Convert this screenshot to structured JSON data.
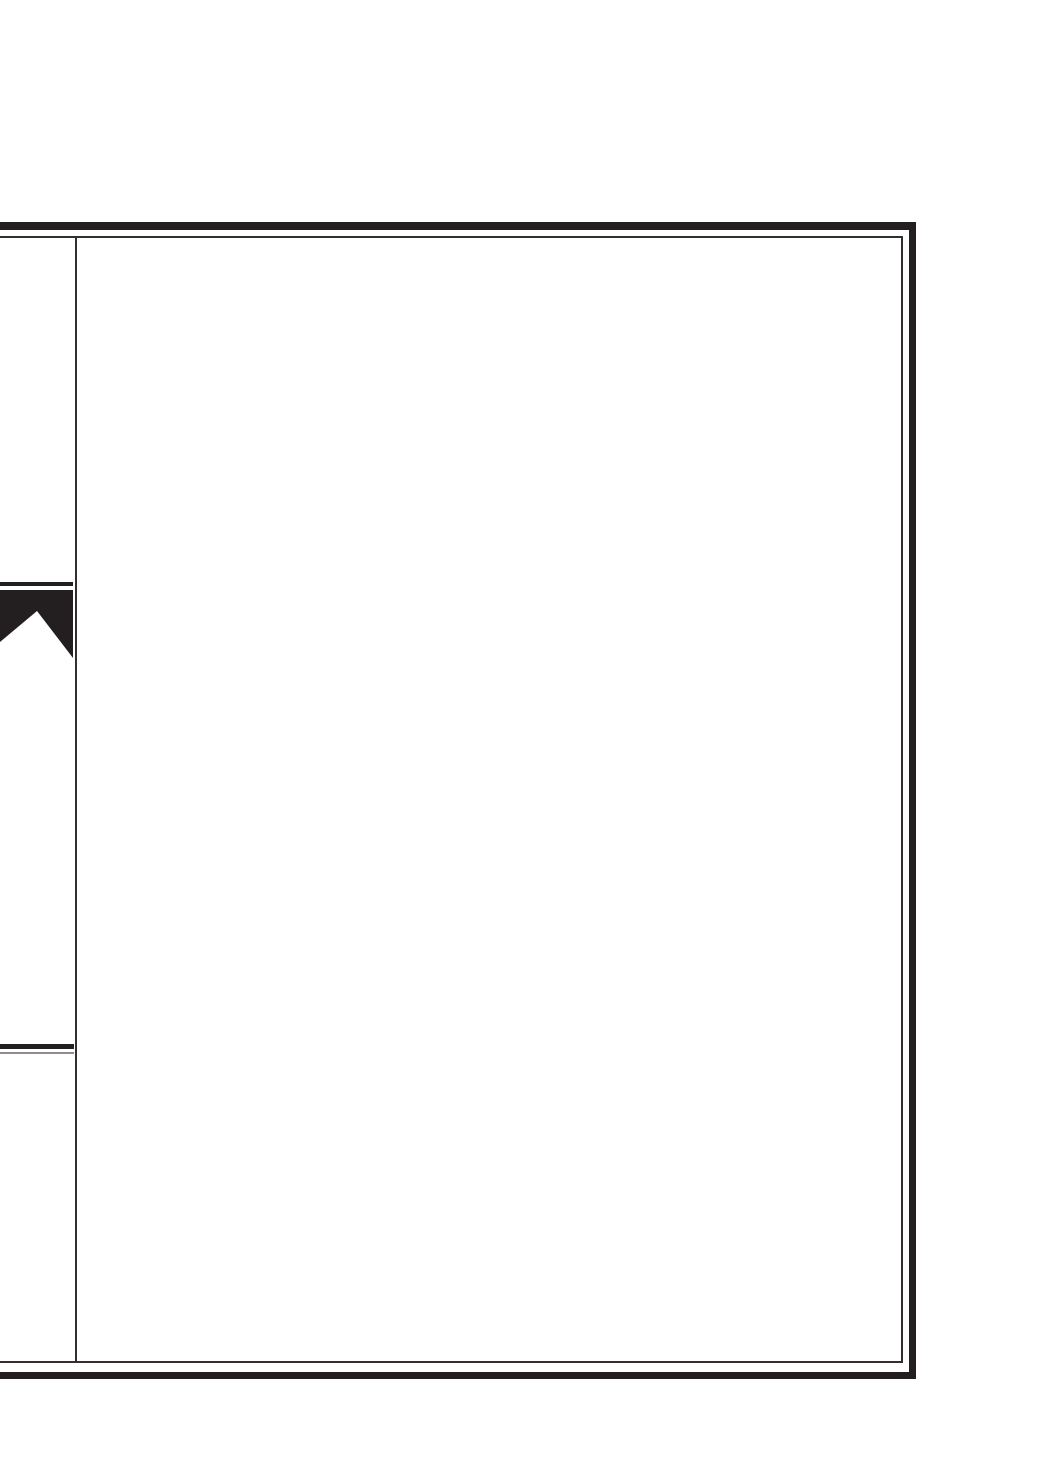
{
  "page": {
    "background": "#ffffff"
  },
  "colors": {
    "ink_black": "#231f20",
    "line_dark": "#332e30",
    "line_gray": "#8e8e8e"
  },
  "icons": {
    "chapter_tab": "banner-ribbon-icon"
  }
}
